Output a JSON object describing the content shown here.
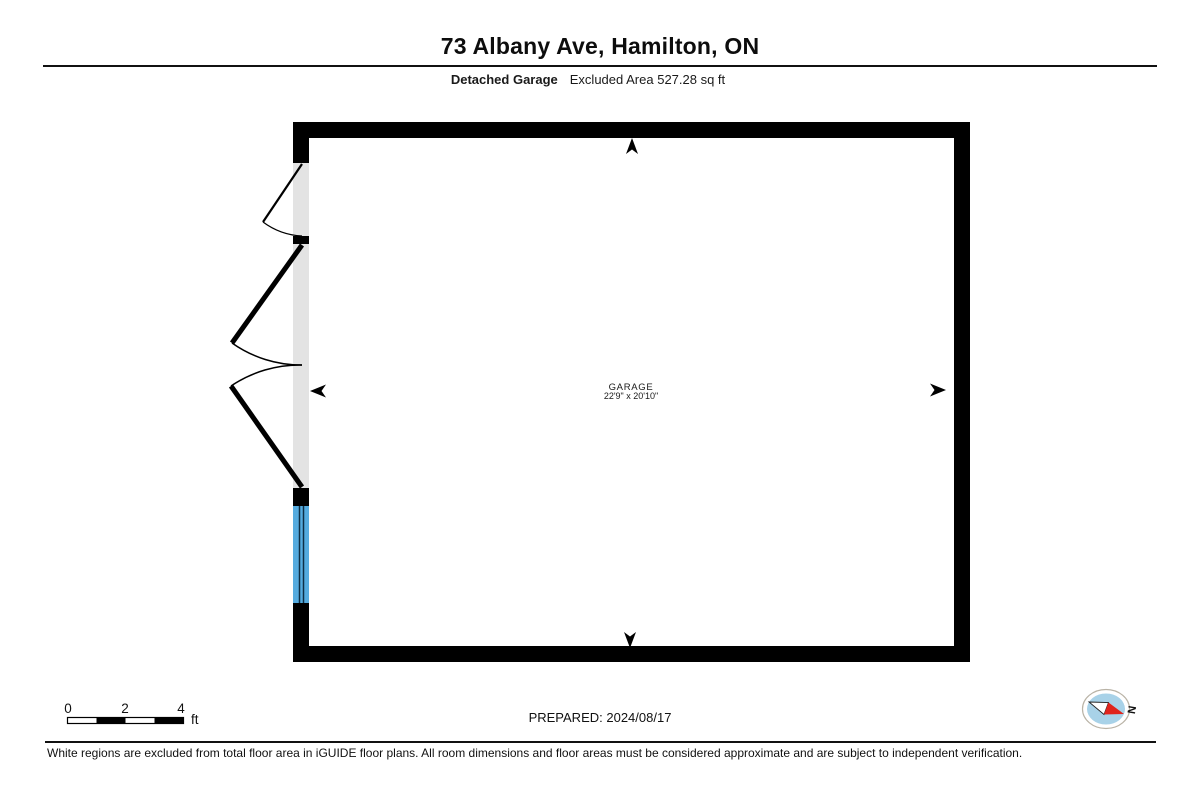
{
  "header": {
    "title": "73 Albany Ave, Hamilton, ON",
    "subtitle_bold": "Detached Garage",
    "subtitle_regular": "Excluded Area 527.28 sq ft"
  },
  "floorplan": {
    "room_name": "GARAGE",
    "room_dimensions": "22'9\" x 20'10\"",
    "colors": {
      "wall": "#000000",
      "wall_opening_gray": "#e3e3e3",
      "window_blue": "#55abdf"
    }
  },
  "footer": {
    "scale": {
      "ticks": [
        "0",
        "2",
        "4"
      ],
      "unit": "ft"
    },
    "prepared_label": "PREPARED: 2024/08/17",
    "compass": {
      "label": "N",
      "dial_blue": "#a8d2e8",
      "needle_red": "#e0241c"
    },
    "disclaimer": "White regions are excluded from total floor area in iGUIDE floor plans. All room dimensions and floor areas must be considered approximate and are subject to independent verification."
  }
}
